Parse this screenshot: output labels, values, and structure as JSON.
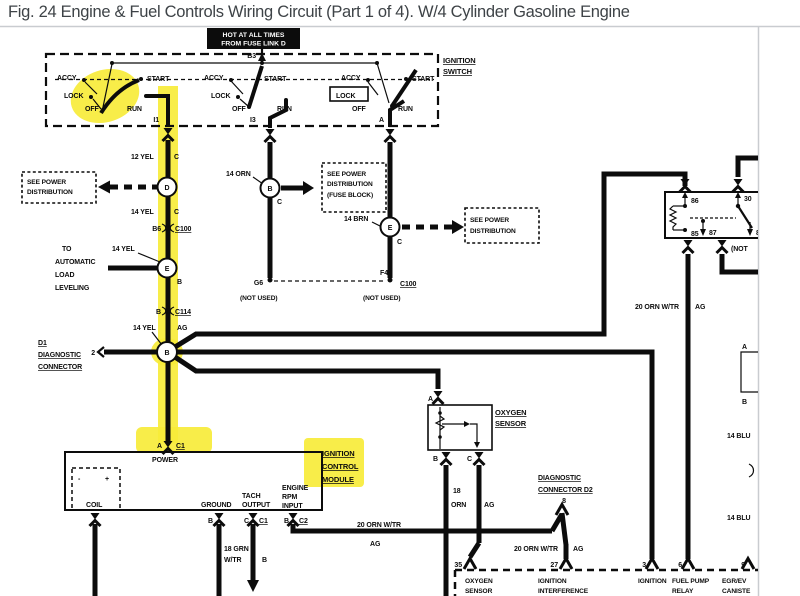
{
  "colors": {
    "highlight": "#f7ec3a",
    "ink": "#0c0c0c",
    "frame": "#c9ccd0"
  },
  "title": "Fig. 24 Engine & Fuel Controls Wiring Circuit (Part 1 of 4). W/4 Cylinder Gasoline Engine",
  "hot": {
    "l1": "HOT AT ALL TIMES",
    "l2": "FROM FUSE LINK D"
  },
  "sw": {
    "b3": "B3",
    "name1": "IGNITION",
    "name2": "SWITCH",
    "g1": {
      "accy": "ACCY",
      "lock": "LOCK",
      "off": "OFF",
      "run": "RUN",
      "start": "START",
      "term": "I1"
    },
    "g2": {
      "accy": "ACCY",
      "lock": "LOCK",
      "off": "OFF",
      "run": "RUN",
      "start": "START",
      "term": "I3"
    },
    "g3": {
      "accy": "ACCY",
      "lock": "LOCK",
      "off": "OFF",
      "run": "RUN",
      "start": "START",
      "term": "A"
    }
  },
  "pwr1": {
    "l1": "SEE POWER",
    "l2": "DISTRIBUTION"
  },
  "pwr2": {
    "l1": "SEE POWER",
    "l2": "DISTRIBUTION",
    "l3": "(FUSE BLOCK)"
  },
  "pwr3": {
    "l1": "SEE POWER",
    "l2": "DISTRIBUTION"
  },
  "colL": {
    "w12": "12 YEL",
    "c1": "C",
    "d": "D",
    "w14a": "14 YEL",
    "c2": "C",
    "b6": "B6",
    "c100": "C100",
    "w14b": "14 YEL",
    "to1": "TO",
    "to2": "AUTOMATIC",
    "to3": "LOAD",
    "to4": "LEVELING",
    "e": "E",
    "eb": "B",
    "b1": "B",
    "c114": "C114",
    "w14c": "14 YEL",
    "ag": "AG",
    "b": "B"
  },
  "d1": {
    "l0": "D1",
    "l1": "DIAGNOSTIC",
    "l2": "CONNECTOR",
    "pin": "2"
  },
  "mid": {
    "w14orn": "14 ORN",
    "b": "B",
    "c": "C",
    "g6": "G6",
    "nu": "(NOT USED)"
  },
  "colA": {
    "w14brn": "14 BRN",
    "e": "E",
    "c": "C",
    "f4": "F4",
    "c100": "C100",
    "nu": "(NOT USED)"
  },
  "relay": {
    "t86": "86",
    "t30": "30",
    "t85": "85",
    "t87": "87",
    "t8": "8",
    "not": "(NOT",
    "w20": "20 ORN W/TR",
    "ag": "AG"
  },
  "right": {
    "a": "A",
    "b": "B",
    "blu1": "14 BLU",
    "blu2": "14 BLU"
  },
  "icm": {
    "h1": "IGNITION",
    "h2": "CONTROL",
    "h3": "MODULE",
    "a": "A",
    "c1": "C1",
    "power": "POWER",
    "minus": "-",
    "plus": "+",
    "coil": "COIL",
    "ground": "GROUND",
    "gb": "B",
    "tach1": "TACH",
    "tach2": "OUTPUT",
    "tc": "C",
    "tc1": "C1",
    "w18a": "18 GRN",
    "w18b": "W/TR",
    "tb": "B",
    "e1": "ENGINE",
    "e2": "RPM",
    "e3": "INPUT",
    "rb": "B",
    "rc2": "C2",
    "w20": "20 ORN W/TR",
    "ag": "AG"
  },
  "ox": {
    "a": "A",
    "b": "B",
    "c": "C",
    "n1": "OXYGEN",
    "n2": "SENSOR",
    "g": "18",
    "col": "ORN",
    "ag": "AG"
  },
  "d2": {
    "l1": "DIAGNOSTIC",
    "l2": "CONNECTOR D2",
    "pin": "8",
    "w20": "20 ORN W/TR",
    "ag": "AG"
  },
  "ecm": {
    "t35": "35",
    "m35a": "OXYGEN",
    "m35b": "SENSOR",
    "t27": "27",
    "m27a": "IGNITION",
    "m27b": "INTERFERENCE",
    "m27c": "OUTPUT",
    "t3": "3",
    "m3": "IGNITION",
    "t6": "6",
    "m6a": "FUEL PUMP",
    "m6b": "RELAY",
    "t9": "9",
    "m9a": "EGR/EV",
    "m9b": "CANISTE"
  }
}
